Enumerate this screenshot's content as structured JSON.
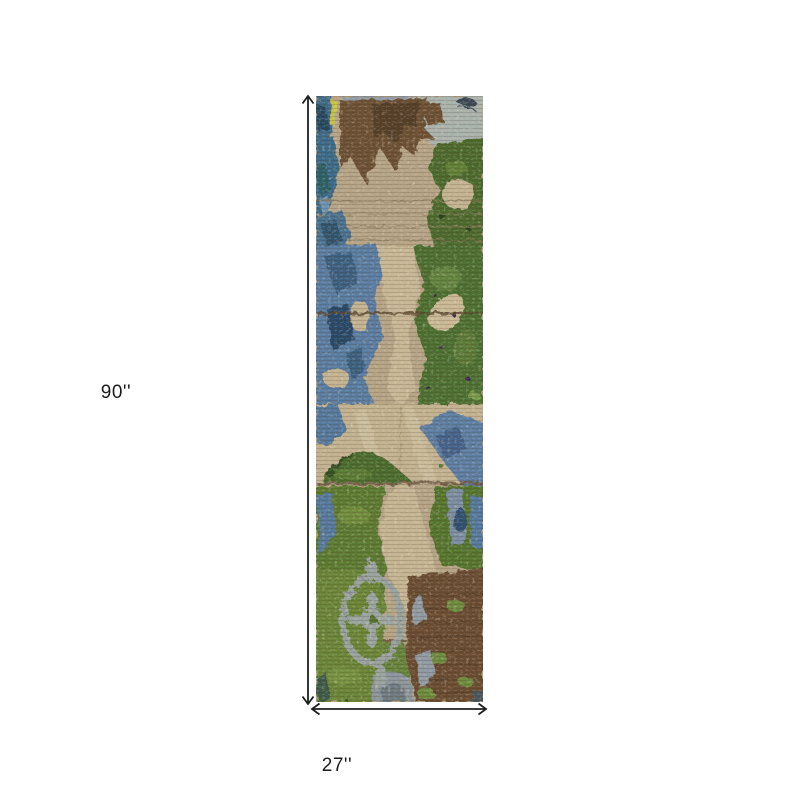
{
  "diagram": {
    "height_label": "90''",
    "width_label": "27''",
    "height_value_inches": 90,
    "width_value_inches": 27,
    "line_color": "#1f1f1f",
    "background": "#ffffff"
  },
  "rug": {
    "name": "abstract distressed runner rug in green, blue, tan and brown",
    "palette": {
      "tan_base": "#b5a385",
      "beige": "#c6b695",
      "brown": "#6d5134",
      "dark_brown": "#57412a",
      "wood_brown": "#6b4e33",
      "steel_blue": "#5a7ca0",
      "navy": "#2c4a68",
      "teal": "#2f6066",
      "green": "#4e6f30",
      "light_green": "#6f8c3e",
      "olive": "#66823a",
      "gray_blue_band": "#8f9aa1",
      "pale_gray": "#a9b1ab",
      "medallion_gray": "#99a29e",
      "yellow": "#c6c244",
      "purple": "#3f2753"
    }
  }
}
